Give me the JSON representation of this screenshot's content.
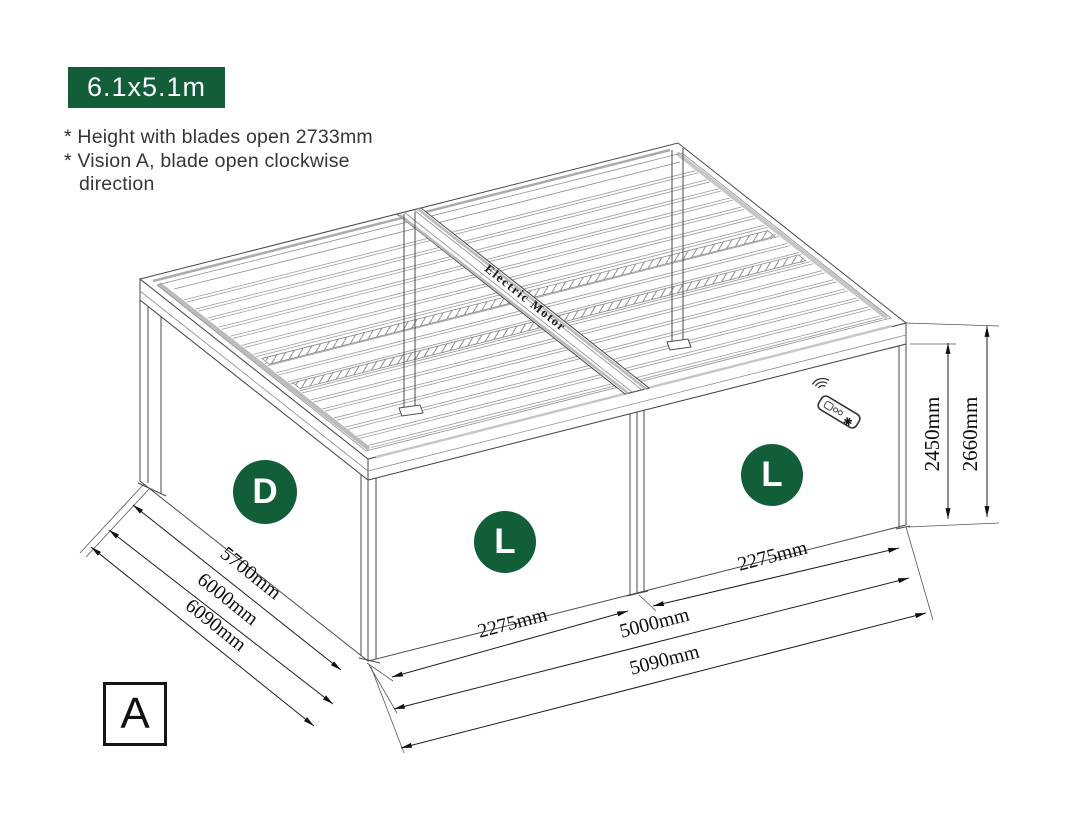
{
  "badge": {
    "label": "6.1x5.1m"
  },
  "notes": {
    "line1": "* Height with blades open 2733mm",
    "line2": "* Vision A, blade open clockwise",
    "line3": "direction"
  },
  "diagram": {
    "motor_label": "Electric Motor",
    "view_marker": "A",
    "zones": {
      "side_wall": "D",
      "front_left_bay": "L",
      "front_right_bay": "L"
    },
    "dimensions": {
      "side": [
        "5700mm",
        "6000mm",
        "6090mm"
      ],
      "front_bay_left": "2275mm",
      "front_bay_right": "2275mm",
      "front_inner": "5000mm",
      "front_outer": "5090mm",
      "height_post": "2450mm",
      "height_total": "2660mm"
    },
    "icons": {
      "remote": "remote-control"
    }
  },
  "colors": {
    "accent_green": "#115e39",
    "line": "#3d3d3d"
  }
}
